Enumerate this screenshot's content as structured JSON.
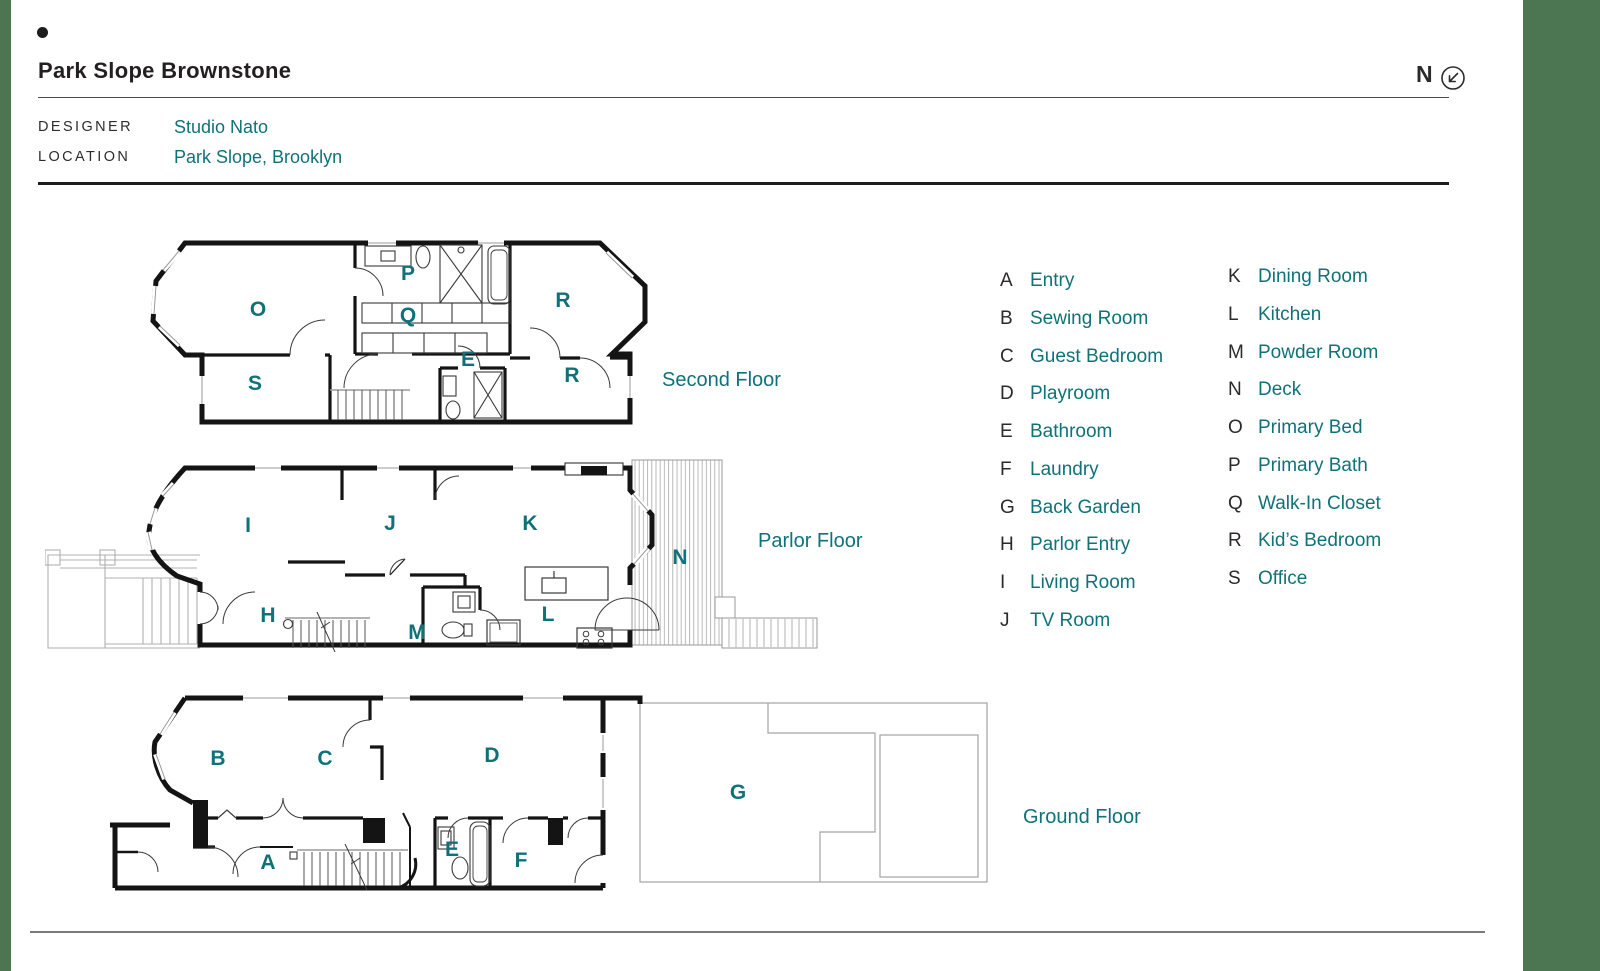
{
  "page": {
    "title": "Park Slope Brownstone",
    "compass_label": "N"
  },
  "meta": {
    "designer_label": "DESIGNER",
    "designer_value": "Studio Nato",
    "location_label": "LOCATION",
    "location_value": "Park Slope, Brooklyn"
  },
  "colors": {
    "teal_text": "#0F7278",
    "side_band_green": "#4C7552",
    "ink": "#231F20",
    "wall_black": "#141414",
    "site_gray": "#ABABAB"
  },
  "floors": [
    {
      "name": "Second Floor",
      "rooms": [
        {
          "letter": "O"
        },
        {
          "letter": "P"
        },
        {
          "letter": "Q"
        },
        {
          "letter": "R"
        },
        {
          "letter": "S"
        },
        {
          "letter": "E"
        },
        {
          "letter": "R"
        }
      ]
    },
    {
      "name": "Parlor Floor",
      "rooms": [
        {
          "letter": "I"
        },
        {
          "letter": "J"
        },
        {
          "letter": "K"
        },
        {
          "letter": "N"
        },
        {
          "letter": "H"
        },
        {
          "letter": "M"
        },
        {
          "letter": "L"
        }
      ]
    },
    {
      "name": "Ground Floor",
      "rooms": [
        {
          "letter": "B"
        },
        {
          "letter": "C"
        },
        {
          "letter": "D"
        },
        {
          "letter": "A"
        },
        {
          "letter": "E"
        },
        {
          "letter": "F"
        },
        {
          "letter": "G"
        }
      ]
    }
  ],
  "legend": {
    "column1": [
      {
        "letter": "A",
        "label": "Entry"
      },
      {
        "letter": "B",
        "label": "Sewing Room"
      },
      {
        "letter": "C",
        "label": "Guest Bedroom"
      },
      {
        "letter": "D",
        "label": "Playroom"
      },
      {
        "letter": "E",
        "label": "Bathroom"
      },
      {
        "letter": "F",
        "label": "Laundry"
      },
      {
        "letter": "G",
        "label": "Back Garden"
      },
      {
        "letter": "H",
        "label": "Parlor Entry"
      },
      {
        "letter": "I",
        "label": "Living Room"
      },
      {
        "letter": "J",
        "label": "TV Room"
      }
    ],
    "column2": [
      {
        "letter": "K",
        "label": "Dining Room"
      },
      {
        "letter": "L",
        "label": "Kitchen"
      },
      {
        "letter": "M",
        "label": "Powder Room"
      },
      {
        "letter": "N",
        "label": "Deck"
      },
      {
        "letter": "O",
        "label": "Primary Bed"
      },
      {
        "letter": "P",
        "label": "Primary Bath"
      },
      {
        "letter": "Q",
        "label": "Walk-In Closet"
      },
      {
        "letter": "R",
        "label": "Kid’s Bedroom"
      },
      {
        "letter": "S",
        "label": "Office"
      }
    ]
  }
}
